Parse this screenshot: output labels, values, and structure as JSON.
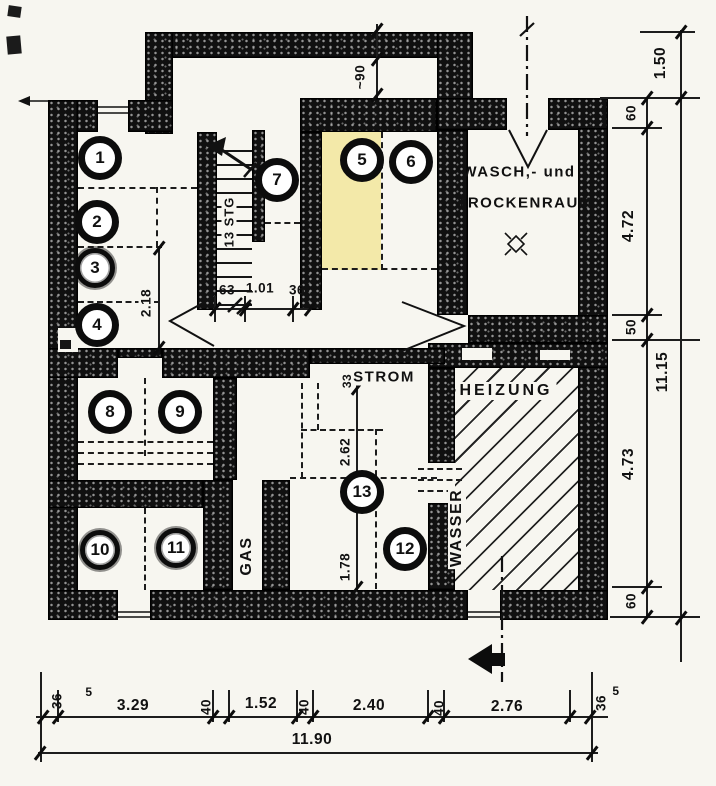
{
  "colors": {
    "paper": "#f7f6f0",
    "ink": "#101010",
    "highlight": "#f3e9a9"
  },
  "labels": {
    "wasch_line1": "WASCH,- und",
    "wasch_line2": "TROCKENRAUM",
    "heizung": "HEIZUNG",
    "strom": "STROM",
    "gas": "GAS",
    "wasser": "WASSER",
    "stairs": "13 STG"
  },
  "circles": [
    {
      "n": "1"
    },
    {
      "n": "2"
    },
    {
      "n": "3"
    },
    {
      "n": "4"
    },
    {
      "n": "5"
    },
    {
      "n": "6"
    },
    {
      "n": "7"
    },
    {
      "n": "8"
    },
    {
      "n": "9"
    },
    {
      "n": "10"
    },
    {
      "n": "11"
    },
    {
      "n": "12"
    },
    {
      "n": "13"
    }
  ],
  "dims": {
    "right_inner": [
      {
        "v": "60"
      },
      {
        "v": "4.72"
      },
      {
        "v": "50"
      },
      {
        "v": "4.73"
      },
      {
        "v": "60"
      }
    ],
    "right_outer": [
      {
        "v": "1.50"
      },
      {
        "v": "11.15"
      }
    ],
    "bottom": {
      "left_small": "36",
      "left_sup": "5",
      "segments": [
        {
          "v": "3.29"
        },
        {
          "v": "40"
        },
        {
          "v": "1.52"
        },
        {
          "v": "40"
        },
        {
          "v": "2.40"
        },
        {
          "v": "40"
        },
        {
          "v": "2.76"
        }
      ],
      "right_small": "36",
      "right_sup": "5",
      "total": "11.90"
    },
    "interior": {
      "top_opening": "~90",
      "hall": [
        {
          "v": "63"
        },
        {
          "v": "1.01"
        },
        {
          "v": "36"
        }
      ],
      "left_room": "2.18",
      "mid_upper": "2.62",
      "mid_lower": "1.78",
      "niche": "33"
    }
  }
}
